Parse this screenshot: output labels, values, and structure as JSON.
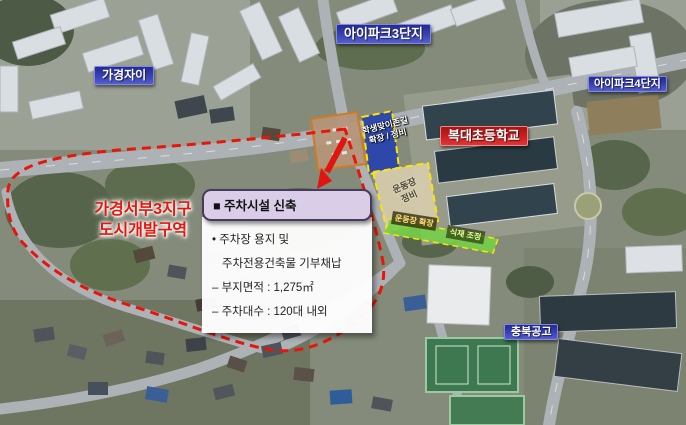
{
  "labels": {
    "apt_left": "가경자이",
    "apt_center": "아이파크3단지",
    "apt_right": "아이파크4단지",
    "school_center": "복대초등학교",
    "school_bottom": "충북공고",
    "district": [
      "가경서부3지구",
      "도시개발구역"
    ]
  },
  "zones": {
    "student_zone": [
      "학생맞이존길",
      "확장 / 정비"
    ],
    "playground_maintain": [
      "운동장",
      "정비"
    ],
    "playground_expand": "운동장 확장",
    "planting_adjust": "식재 조정"
  },
  "callout": {
    "title": "■ 주차시설 신축",
    "lines": [
      "• 주차장 용지 및",
      "주차전용건축물 기부채납",
      "– 부지면적 : 1,275㎡",
      "– 주차대수 : 120대 내외"
    ]
  },
  "colors": {
    "district_boundary": "#e8150a",
    "zone_outline": "#ffe400",
    "label_blue": "#3a43b4",
    "label_red": "#c92121",
    "callout_header_bg": "#d9cde8",
    "site_fill": "#b49679",
    "student_zone_fill": "#2743ae",
    "playground_fill": "#d9cfae",
    "expansion_strip_fill": "#76cf49"
  }
}
